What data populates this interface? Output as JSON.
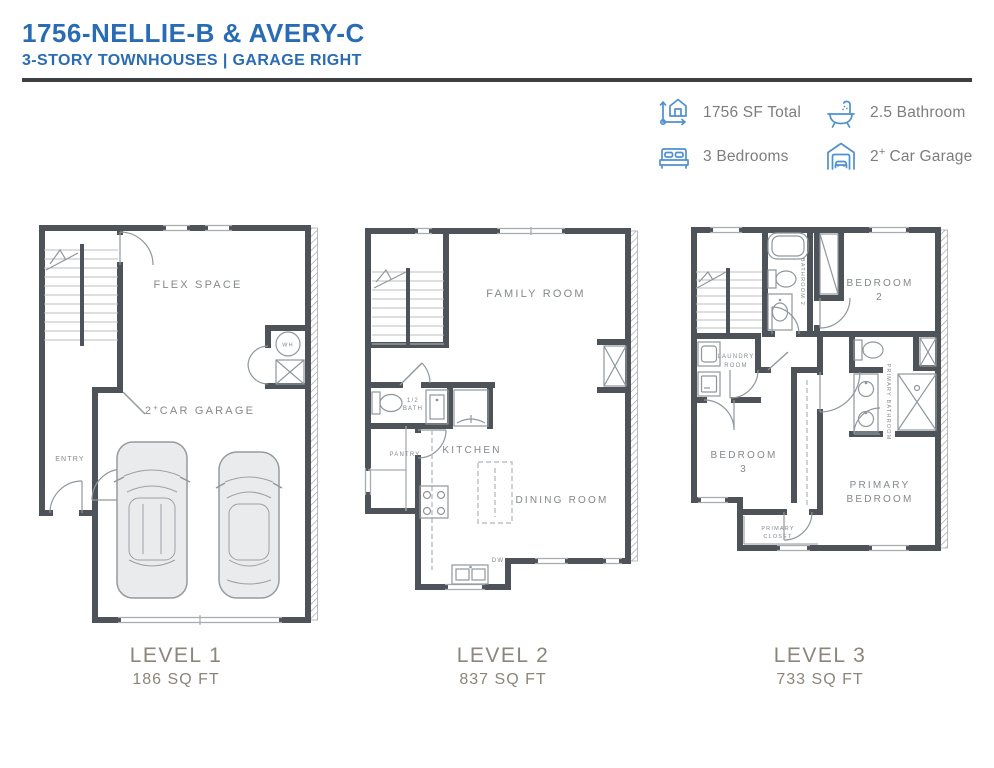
{
  "header": {
    "title": "1756-NELLIE-B & AVERY-C",
    "subtitle": "3-STORY TOWNHOUSES | GARAGE RIGHT"
  },
  "summary": {
    "sf_total": "1756 SF Total",
    "bathrooms": "2.5 Bathroom",
    "bedrooms": "3 Bedrooms",
    "garage_num": "2",
    "garage_sup": "+",
    "garage_rest": "Car Garage"
  },
  "levels": [
    {
      "caption": "LEVEL 1",
      "area": "186 SQ FT",
      "rooms": {
        "flex": "FLEX SPACE",
        "garage_num": "2",
        "garage_sup": "+",
        "garage_rest": "CAR GARAGE",
        "entry": "ENTRY",
        "wh": "WH"
      }
    },
    {
      "caption": "LEVEL 2",
      "area": "837 SQ FT",
      "rooms": {
        "family": "FAMILY ROOM",
        "half_bath_l1": "1/2",
        "half_bath_l2": "BATH",
        "pantry": "PANTRY",
        "kitchen": "KITCHEN",
        "dining": "DINING ROOM",
        "dw": "DW"
      }
    },
    {
      "caption": "LEVEL 3",
      "area": "733 SQ FT",
      "rooms": {
        "bathroom2": "BATHROOM 2",
        "bedroom2_l1": "BEDROOM",
        "bedroom2_l2": "2",
        "laundry_l1": "LAUNDRY",
        "laundry_l2": "ROOM",
        "primary_bath": "PRIMARY BATHROOM",
        "bedroom3_l1": "BEDROOM",
        "bedroom3_l2": "3",
        "primary_bed_l1": "PRIMARY",
        "primary_bed_l2": "BEDROOM",
        "primary_closet_l1": "PRIMARY",
        "primary_closet_l2": "CLOSET"
      }
    }
  ],
  "colors": {
    "accent_blue": "#2a6cb3",
    "icon_blue": "#4f90cf",
    "wall_gray": "#4d5358",
    "caption_gray": "#8b857b",
    "legend_text_gray": "#7d7d7d"
  }
}
